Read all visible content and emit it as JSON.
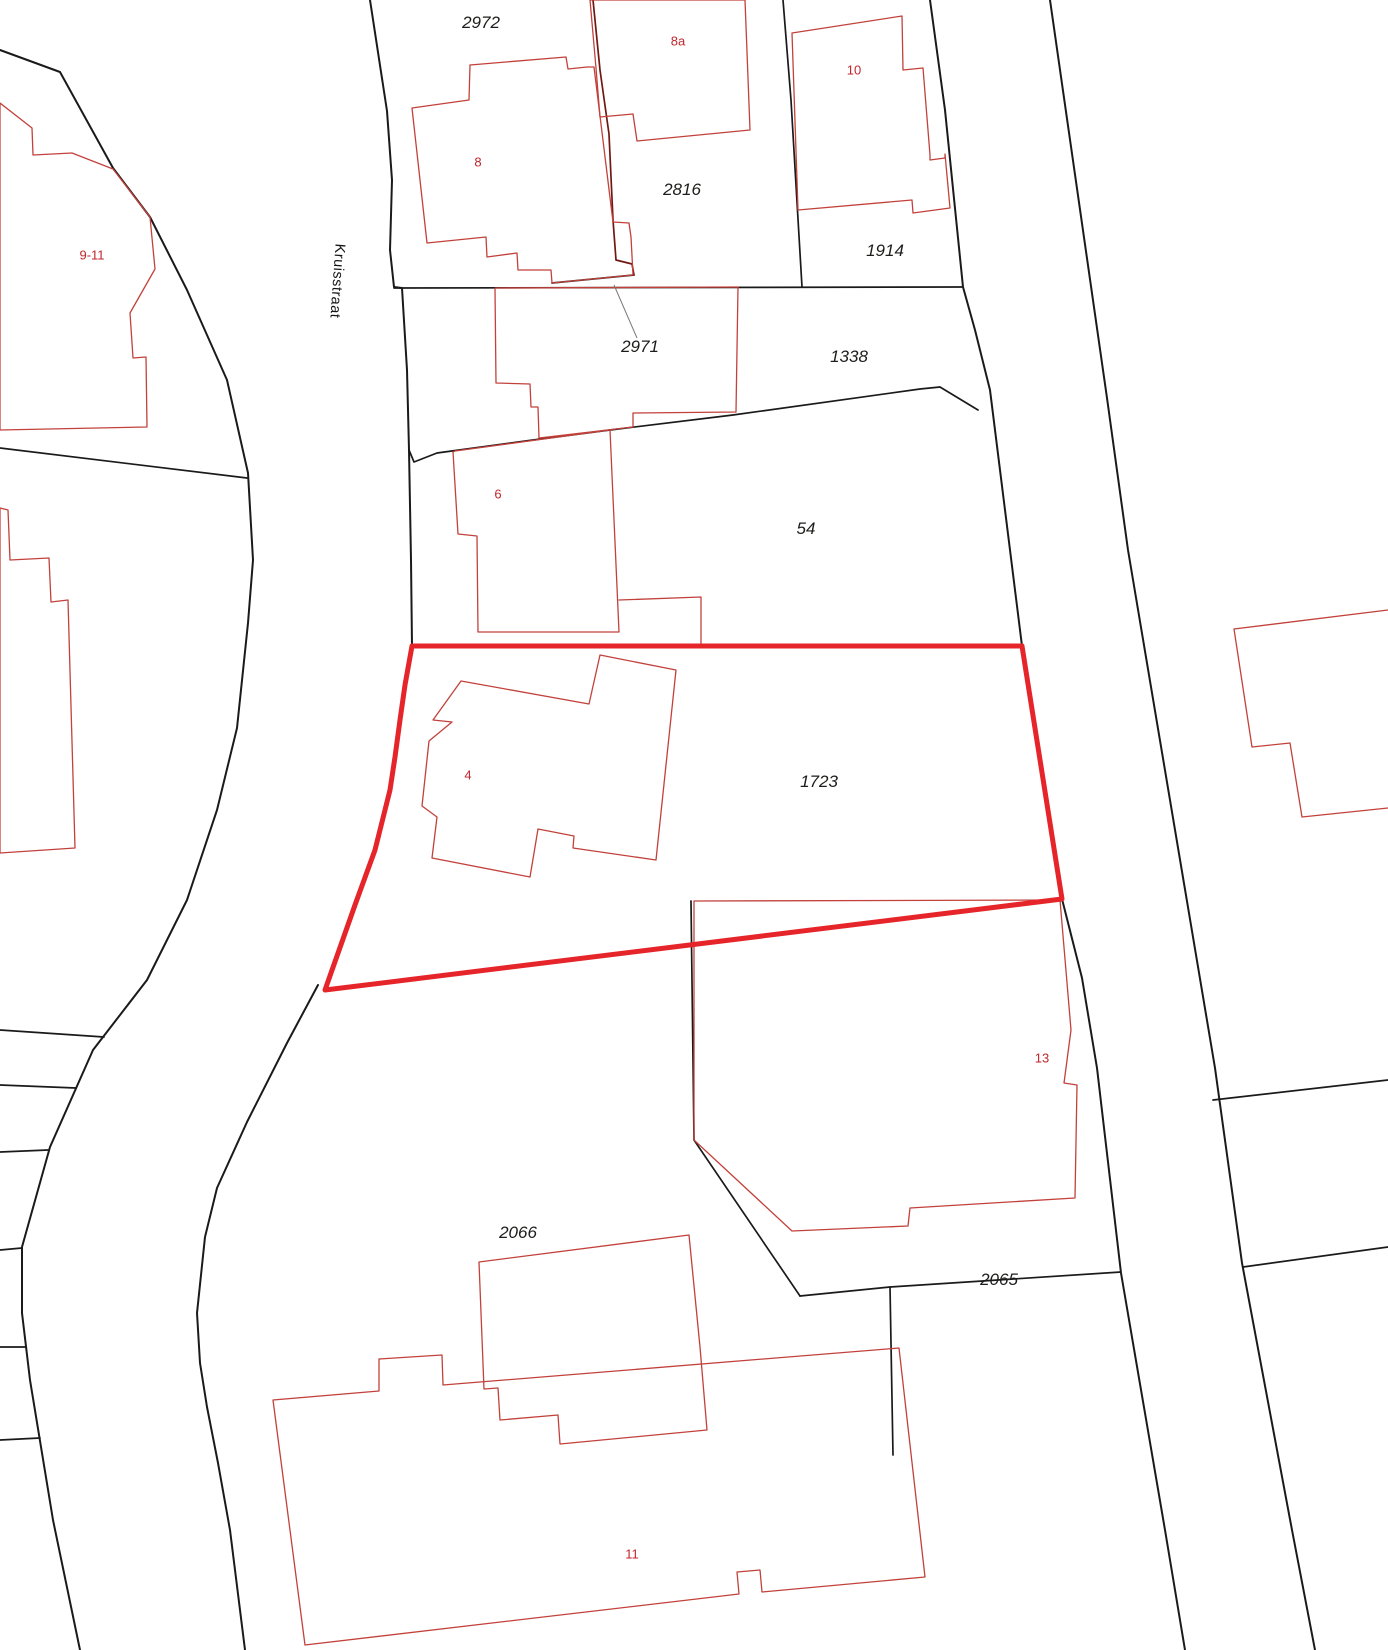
{
  "map": {
    "street": {
      "name": "Kruisstraat",
      "x": 337,
      "y": 281,
      "rotation_deg": 94
    },
    "parcels": [
      {
        "number": "2972",
        "x": 481,
        "y": 23
      },
      {
        "number": "2816",
        "x": 682,
        "y": 190
      },
      {
        "number": "1914",
        "x": 885,
        "y": 251
      },
      {
        "number": "2971",
        "x": 640,
        "y": 347
      },
      {
        "number": "1338",
        "x": 849,
        "y": 357
      },
      {
        "number": "54",
        "x": 806,
        "y": 529
      },
      {
        "number": "1723",
        "x": 819,
        "y": 782
      },
      {
        "number": "2066",
        "x": 518,
        "y": 1233
      },
      {
        "number": "2065",
        "x": 999,
        "y": 1280
      }
    ],
    "houses": [
      {
        "number": "8a",
        "x": 678,
        "y": 41
      },
      {
        "number": "10",
        "x": 854,
        "y": 70
      },
      {
        "number": "8",
        "x": 478,
        "y": 162
      },
      {
        "number": "9-11",
        "x": 92,
        "y": 255
      },
      {
        "number": "6",
        "x": 498,
        "y": 494
      },
      {
        "number": "4",
        "x": 468,
        "y": 775
      },
      {
        "number": "13",
        "x": 1042,
        "y": 1058
      },
      {
        "number": "11",
        "x": 632,
        "y": 1554
      }
    ],
    "highlight": {
      "parcel": "1723",
      "color": "#e5252a"
    },
    "colors": {
      "parcel_line": "#1a1a1a",
      "building_line": "#c2413b",
      "building_on_boundary_line": "#701812",
      "house_number_text": "#c0272d",
      "parcel_number_text": "#1d1d1b",
      "leader_line": "#777777"
    }
  }
}
